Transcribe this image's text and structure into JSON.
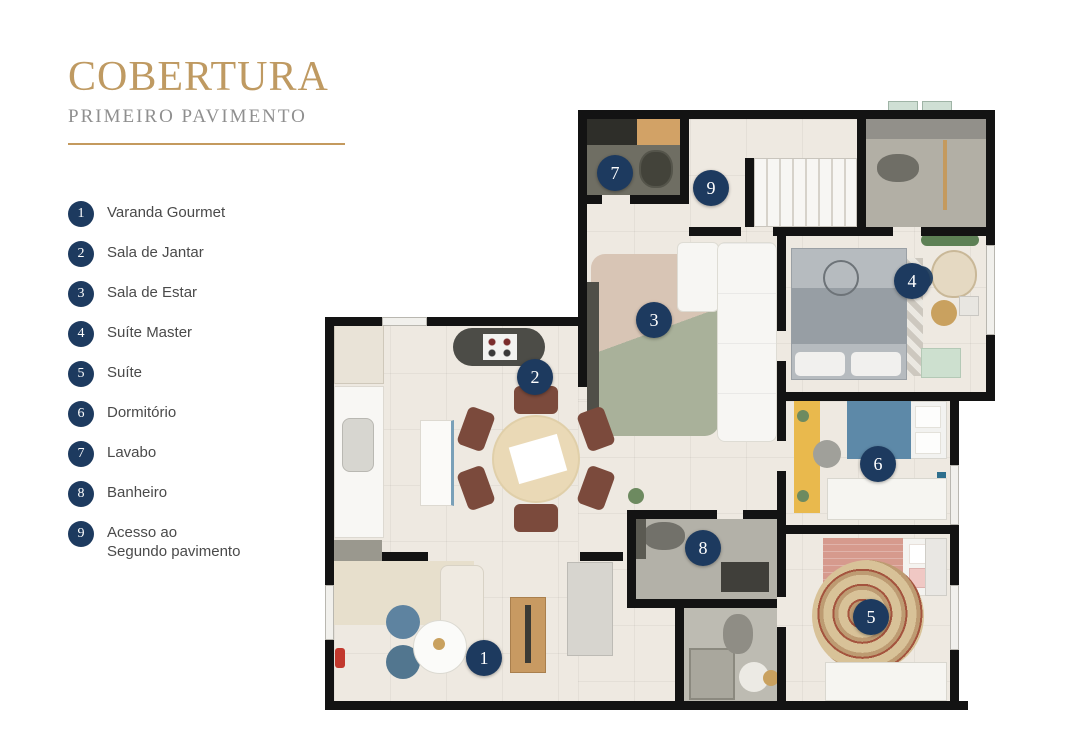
{
  "title": {
    "main": "COBERTURA",
    "subtitle": "PRIMEIRO PAVIMENTO"
  },
  "legend": {
    "items": [
      {
        "number": "1",
        "label": "Varanda Gourmet"
      },
      {
        "number": "2",
        "label": "Sala de Jantar"
      },
      {
        "number": "3",
        "label": "Sala de Estar"
      },
      {
        "number": "4",
        "label": "Suíte Master"
      },
      {
        "number": "5",
        "label": "Suíte"
      },
      {
        "number": "6",
        "label": "Dormitório"
      },
      {
        "number": "7",
        "label": "Lavabo"
      },
      {
        "number": "8",
        "label": "Banheiro"
      },
      {
        "number": "9",
        "label": "Acesso ao",
        "label2": "Segundo pavimento"
      }
    ]
  },
  "plan": {
    "badges": [
      {
        "number": "1",
        "room": "Varanda Gourmet"
      },
      {
        "number": "2",
        "room": "Sala de Jantar"
      },
      {
        "number": "3",
        "room": "Sala de Estar"
      },
      {
        "number": "4",
        "room": "Suíte Master"
      },
      {
        "number": "5",
        "room": "Suíte"
      },
      {
        "number": "6",
        "room": "Dormitório"
      },
      {
        "number": "7",
        "room": "Lavabo"
      },
      {
        "number": "8",
        "room": "Banheiro"
      },
      {
        "number": "9",
        "room": "Acesso ao Segundo pavimento"
      }
    ],
    "colors": {
      "accent_gold": "#bf9a62",
      "badge_navy": "#1d3a5f",
      "wall_black": "#131313"
    }
  }
}
